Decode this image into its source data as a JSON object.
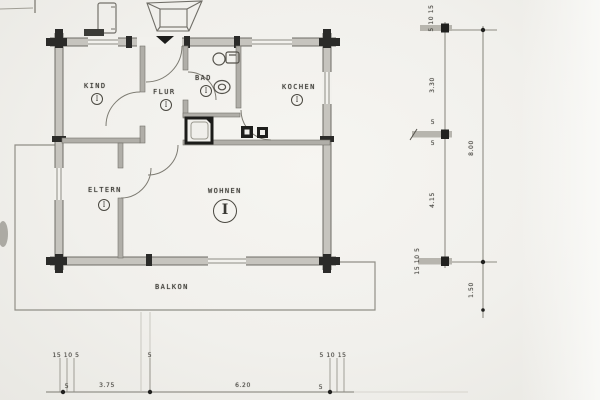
{
  "rooms": {
    "kind": {
      "label": "KIND",
      "numeral": "I"
    },
    "flur": {
      "label": "FLUR",
      "numeral": "I"
    },
    "bad": {
      "label": "BAD",
      "numeral": "I"
    },
    "kochen": {
      "label": "KOCHEN",
      "numeral": "I"
    },
    "eltern": {
      "label": "ELTERN",
      "numeral": "I"
    },
    "wohnen": {
      "label": "WOHNEN",
      "numeral": "I"
    },
    "balkon": {
      "label": "BALKON"
    }
  },
  "dimensions": {
    "right": {
      "wall_top": "5 10 15",
      "upper_depth": "3.30",
      "mid_wall_upper": "5",
      "mid_wall_lower": "5",
      "lower_depth": "4.15",
      "wall_bottom": "15 10 5",
      "total_depth": "8.00",
      "balcony_depth": "1.50"
    },
    "bottom": {
      "wall_left": "15 10 5",
      "left_width": "3.75",
      "left_wall_small": "5",
      "mid_wall": "5",
      "right_width": "6.20",
      "right_wall_small": "5",
      "wall_right": "5 10 15"
    }
  },
  "colors": {
    "paper": "#f2f1ed",
    "wall_fill": "#c6c4be",
    "interior_wall_fill": "#b0aea8",
    "ink_dark": "#21211f",
    "line_gray": "#7d7b72"
  }
}
